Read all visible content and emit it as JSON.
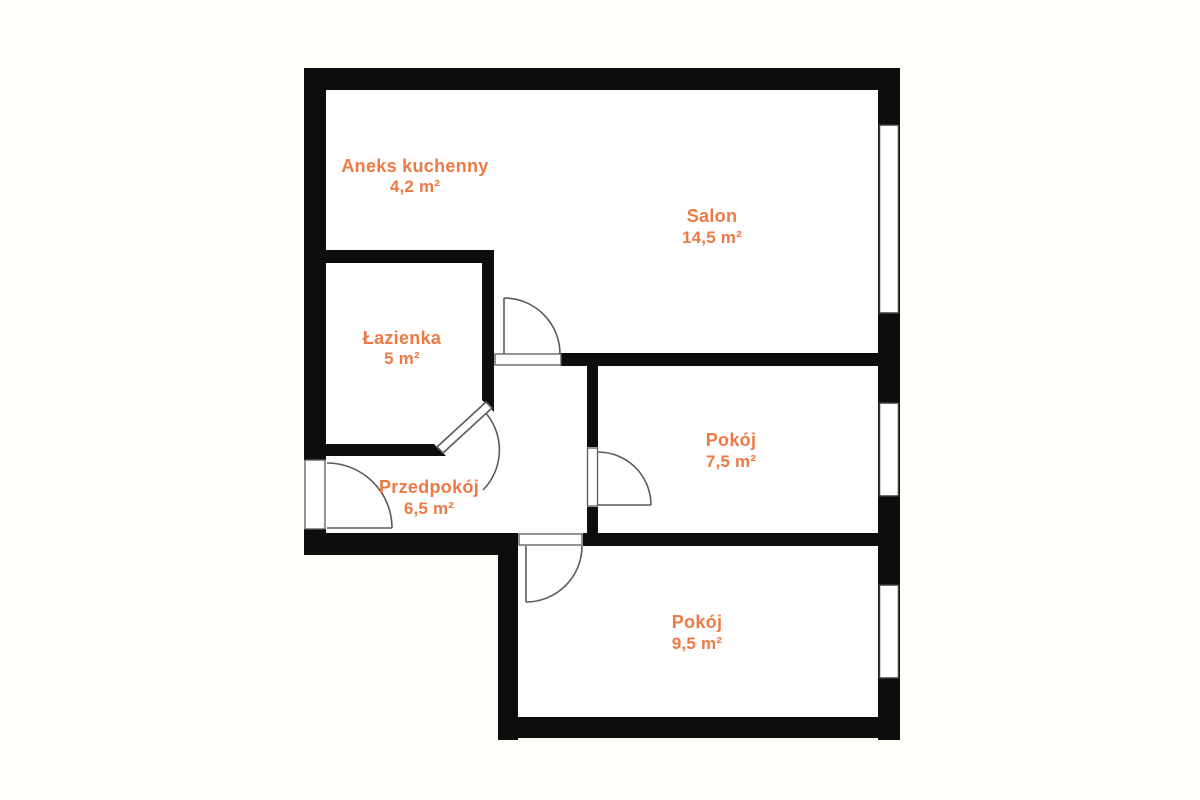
{
  "plan": {
    "type": "apartment-floor-plan"
  },
  "colors": {
    "background": "#FFFDF7",
    "floor": "#FFFFFF",
    "wall": "#0D0D0D",
    "label": "#ED7A45",
    "door": "#5A5A5A",
    "window_frame": "#3D3D3D"
  },
  "rooms": [
    {
      "name": "Aneks kuchenny",
      "area": "4,2 m²"
    },
    {
      "name": "Salon",
      "area": "14,5 m²"
    },
    {
      "name": "Łazienka",
      "area": "5 m²"
    },
    {
      "name": "Przedpokój",
      "area": "6,5 m²"
    },
    {
      "name": "Pokój",
      "area": "7,5 m²"
    },
    {
      "name": "Pokój",
      "area": "9,5 m²"
    }
  ]
}
